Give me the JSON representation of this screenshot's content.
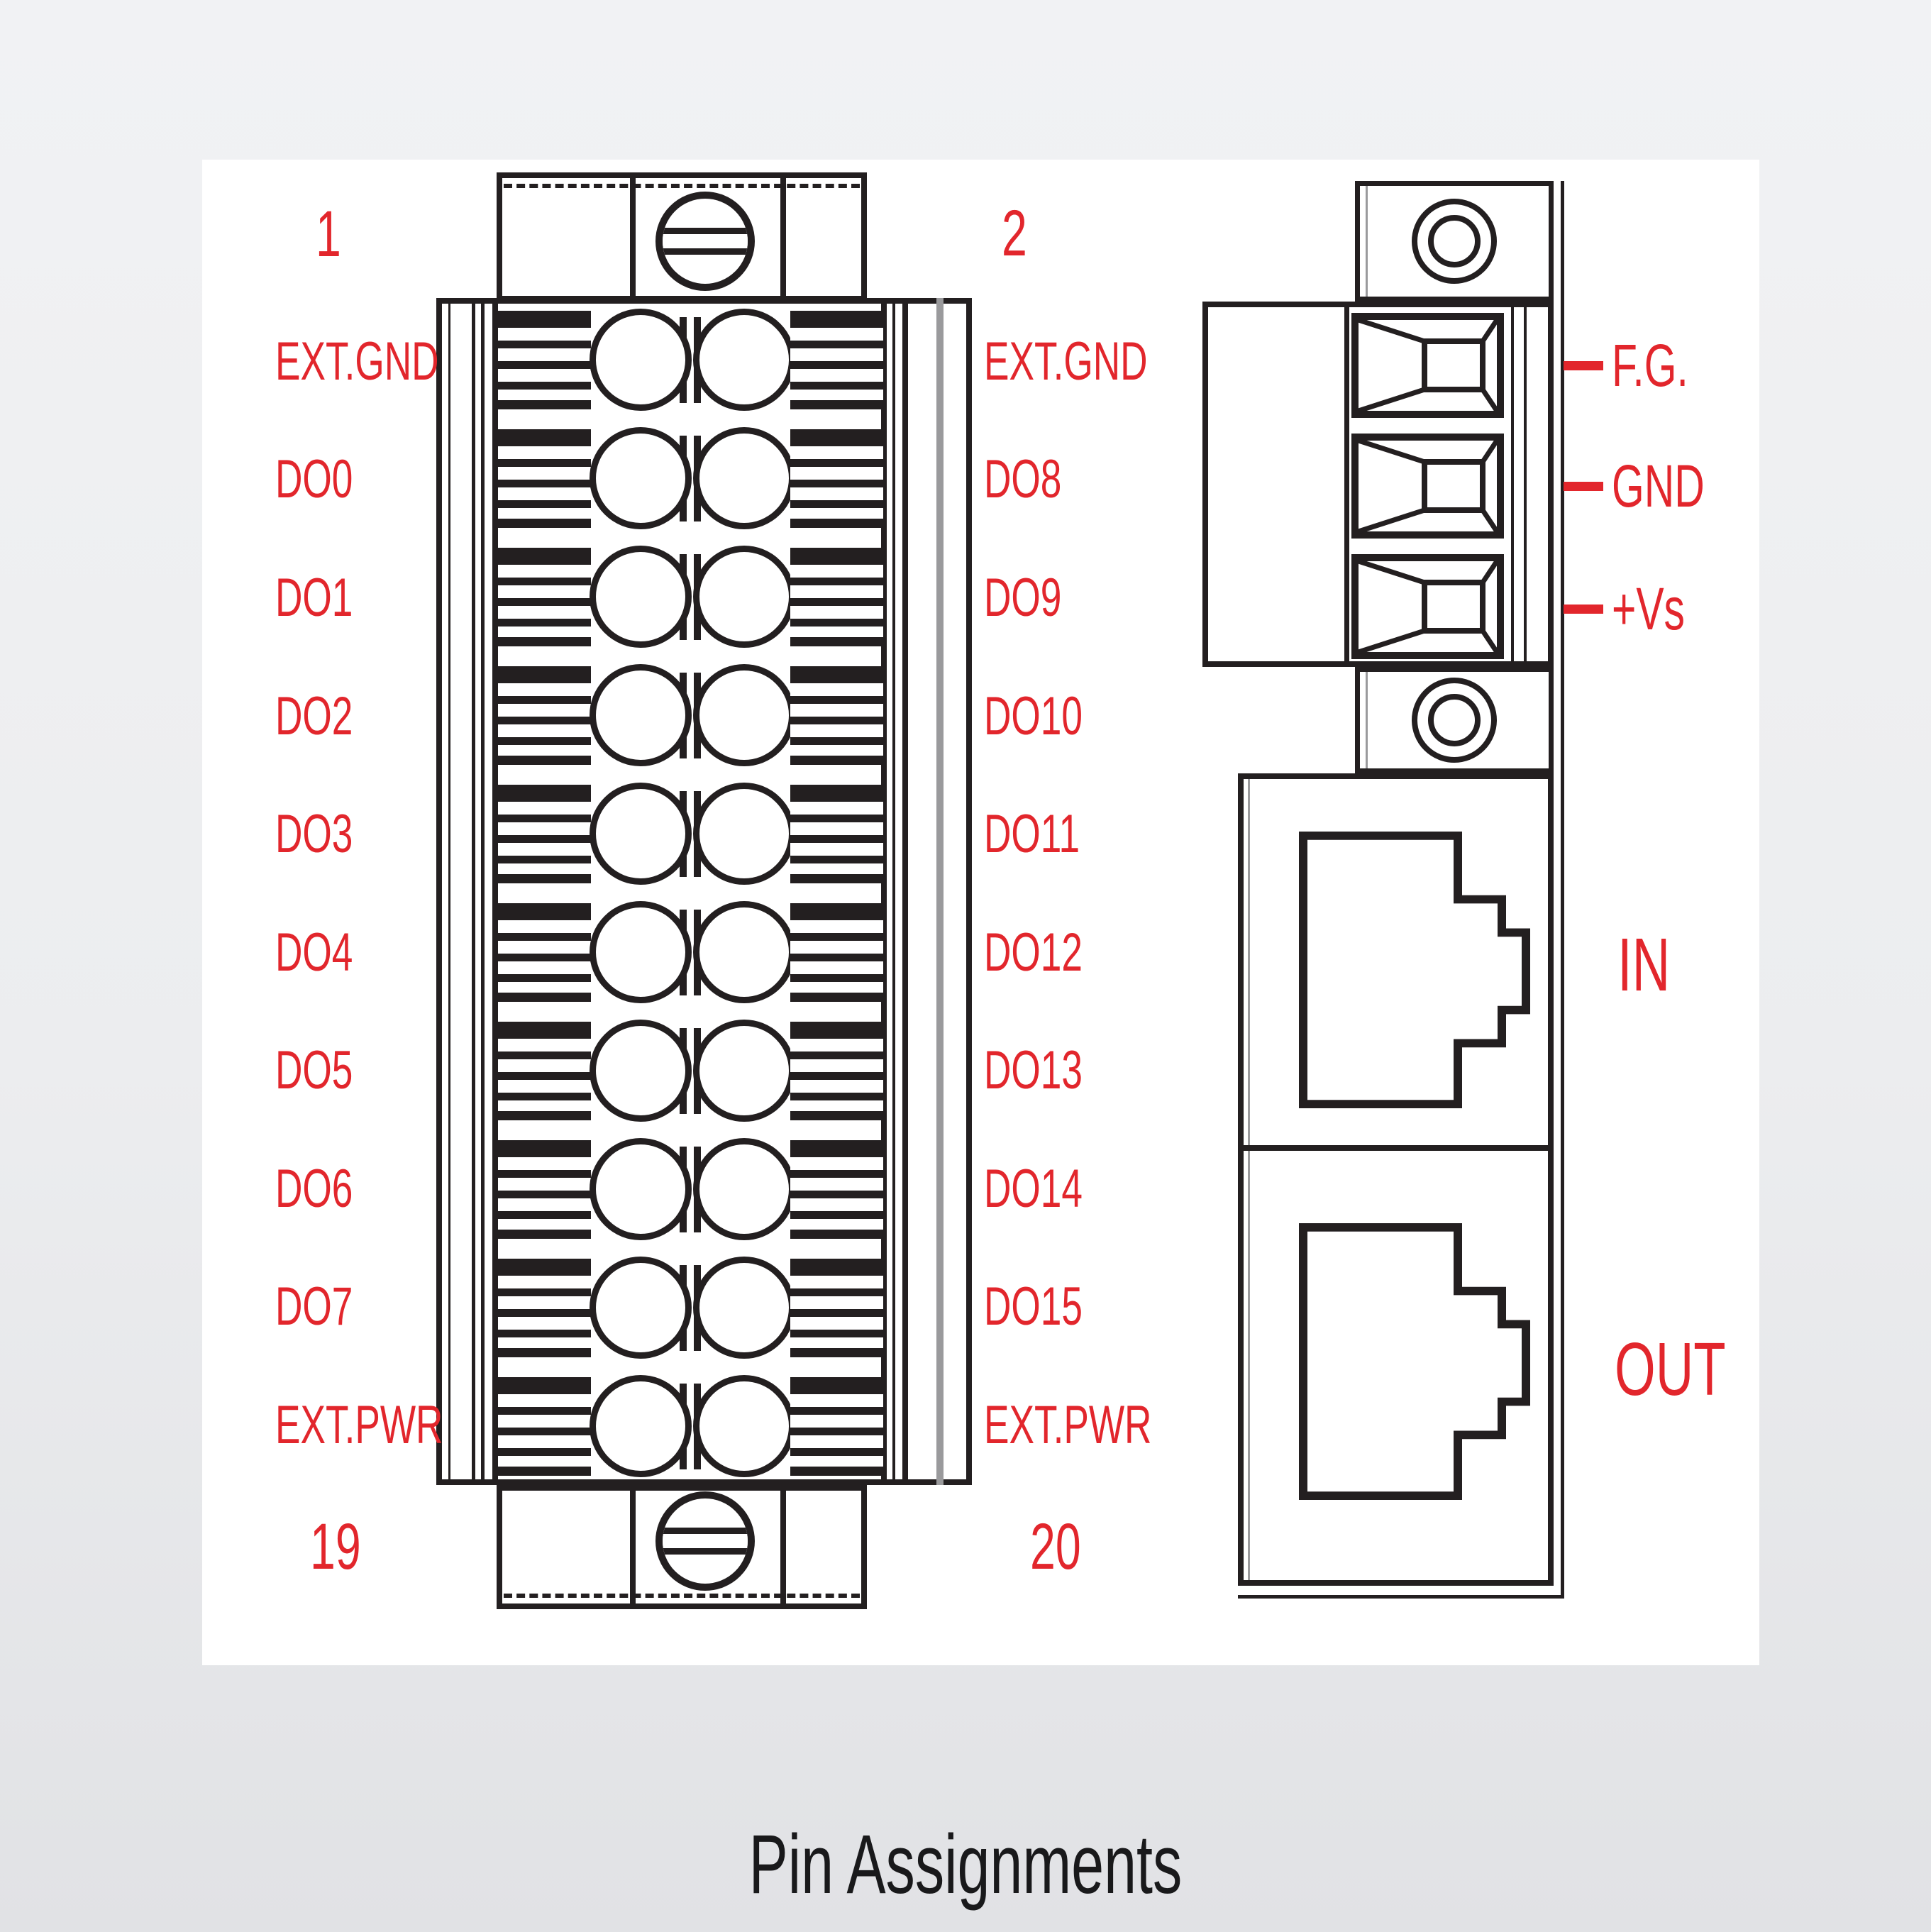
{
  "page": {
    "title": "Pin Assignments"
  },
  "colors": {
    "red": "#e2262c",
    "line": "#231f20",
    "panel": "#ffffff",
    "background": "#ecedef"
  },
  "terminal_block": {
    "corner_pins": {
      "top_left": "1",
      "top_right": "2",
      "bottom_left": "19",
      "bottom_right": "20"
    },
    "left_labels": [
      "EXT.GND",
      "DO0",
      "DO1",
      "DO2",
      "DO3",
      "DO4",
      "DO5",
      "DO6",
      "DO7",
      "EXT.PWR"
    ],
    "right_labels": [
      "EXT.GND",
      "DO8",
      "DO9",
      "DO10",
      "DO11",
      "DO12",
      "DO13",
      "DO14",
      "DO15",
      "EXT.PWR"
    ]
  },
  "side_module": {
    "power_terminals": [
      "F.G.",
      "GND",
      "+Vs"
    ],
    "ports": [
      "IN",
      "OUT"
    ]
  },
  "icons": {
    "screw": "flat-head-screw-icon",
    "screw_hole": "screw-hole-icon",
    "wire_terminal": "wire-clamp-socket-icon",
    "rj45": "rj45-jack-icon"
  }
}
